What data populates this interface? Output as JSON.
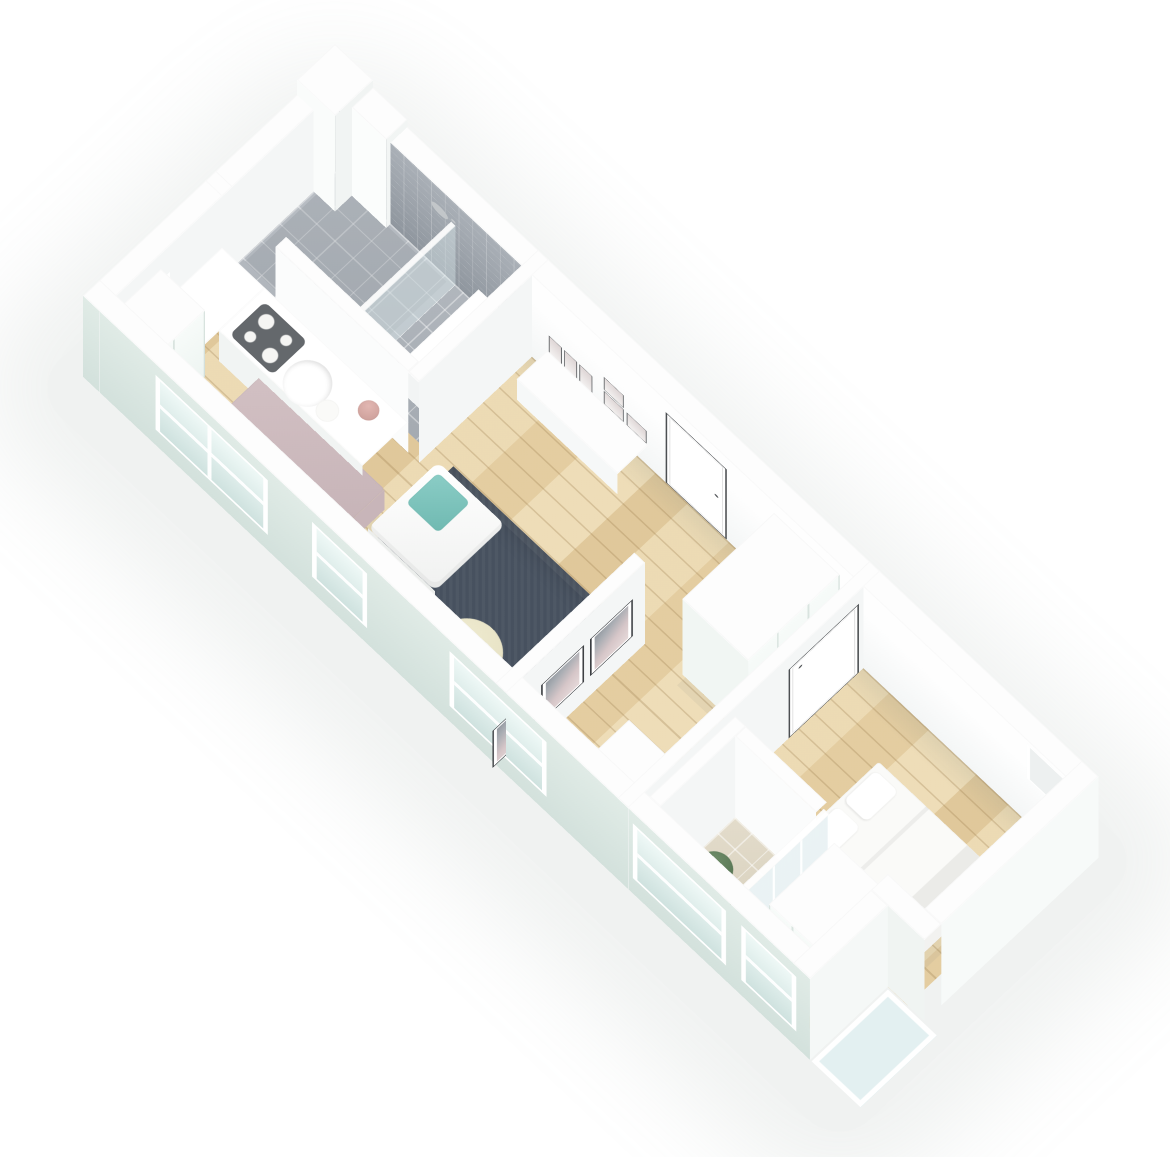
{
  "meta": {
    "type": "isometric-3d-floorplan-render",
    "visible_text": "none",
    "background_color": "#ffffff",
    "view": "axonometric top-down, long axis running upper-left to lower-right"
  },
  "palette": {
    "wall_white": "#fdfdfd",
    "wall_shade": "#f1f4f3",
    "facade_mint": "#d8e5e0",
    "wood_floor": "#e9d6ae",
    "wood_plank_line": "#9c7c4c",
    "rug_dark": "#47515f",
    "teal_cushion": "#7fc5bd",
    "tile_gray_floor": "#b2b7bd",
    "tile_gray_wall": "#9aa1a8",
    "tile_beige": "#ded7c5",
    "table_mauve": "#ccbabd",
    "chair_wood": "#d7a977",
    "cooktop_dark": "#64686c",
    "art_pink": "#d6c6c8",
    "frame_dark": "#33363a",
    "glass_partition": "#dbeef0",
    "terrace_glass": "#e3f0f1",
    "plant_green": "#5d7d58",
    "plant_pink": "#d9a9a4"
  },
  "apartment": {
    "rooms": [
      {
        "name": "bathroom-shower",
        "floor": "gray tile",
        "features": [
          "walk-in shower with gray tiled wall",
          "glass divider",
          "shower head",
          "white storage unit"
        ]
      },
      {
        "name": "kitchen",
        "floor": "light wood",
        "features": [
          "L-shaped white counter",
          "dark cooktop with 4 burners",
          "round white sink and plate",
          "pink plant",
          "tall mint cabinet"
        ]
      },
      {
        "name": "dining-area",
        "floor": "light wood",
        "features": [
          "mauve rectangular table",
          "2 wooden chairs with white cushions"
        ]
      },
      {
        "name": "living-room",
        "floor": "light wood",
        "features": [
          "dark blue-gray rug",
          "white armchair with teal cushion",
          "white ottoman",
          "round cream coffee table with 2 cups",
          "white sideboard",
          "6 leaning picture frames",
          "entry door in back wall"
        ]
      },
      {
        "name": "bedroom-2-office",
        "floor": "light wood",
        "features": [
          "mint-front wardrobe",
          "white desk",
          "3 framed abstract prints on wall"
        ]
      },
      {
        "name": "ensuite-bathroom",
        "floor": "beige tile",
        "features": [
          "green potted plant",
          "glazed partition wall"
        ]
      },
      {
        "name": "bedroom-1",
        "floor": "light wood",
        "features": [
          "double bed, white bedding, 2 pillows",
          "mint-front wardrobe",
          "wall niche",
          "plant at window",
          "interior door"
        ]
      },
      {
        "name": "terrace-notch",
        "floor": "pale glass",
        "features": [
          "L-shaped building cutout at lower right"
        ]
      }
    ],
    "counts": {
      "facade_windows": 5,
      "end_wall_windows": 1,
      "entry_doors": 1,
      "interior_doors": 1,
      "wall_art_prints": 3,
      "leaning_gallery_frames": 6,
      "dining_chairs": 2,
      "bed_pillows": 2,
      "cooktop_burners": 4,
      "plants": 3
    }
  }
}
